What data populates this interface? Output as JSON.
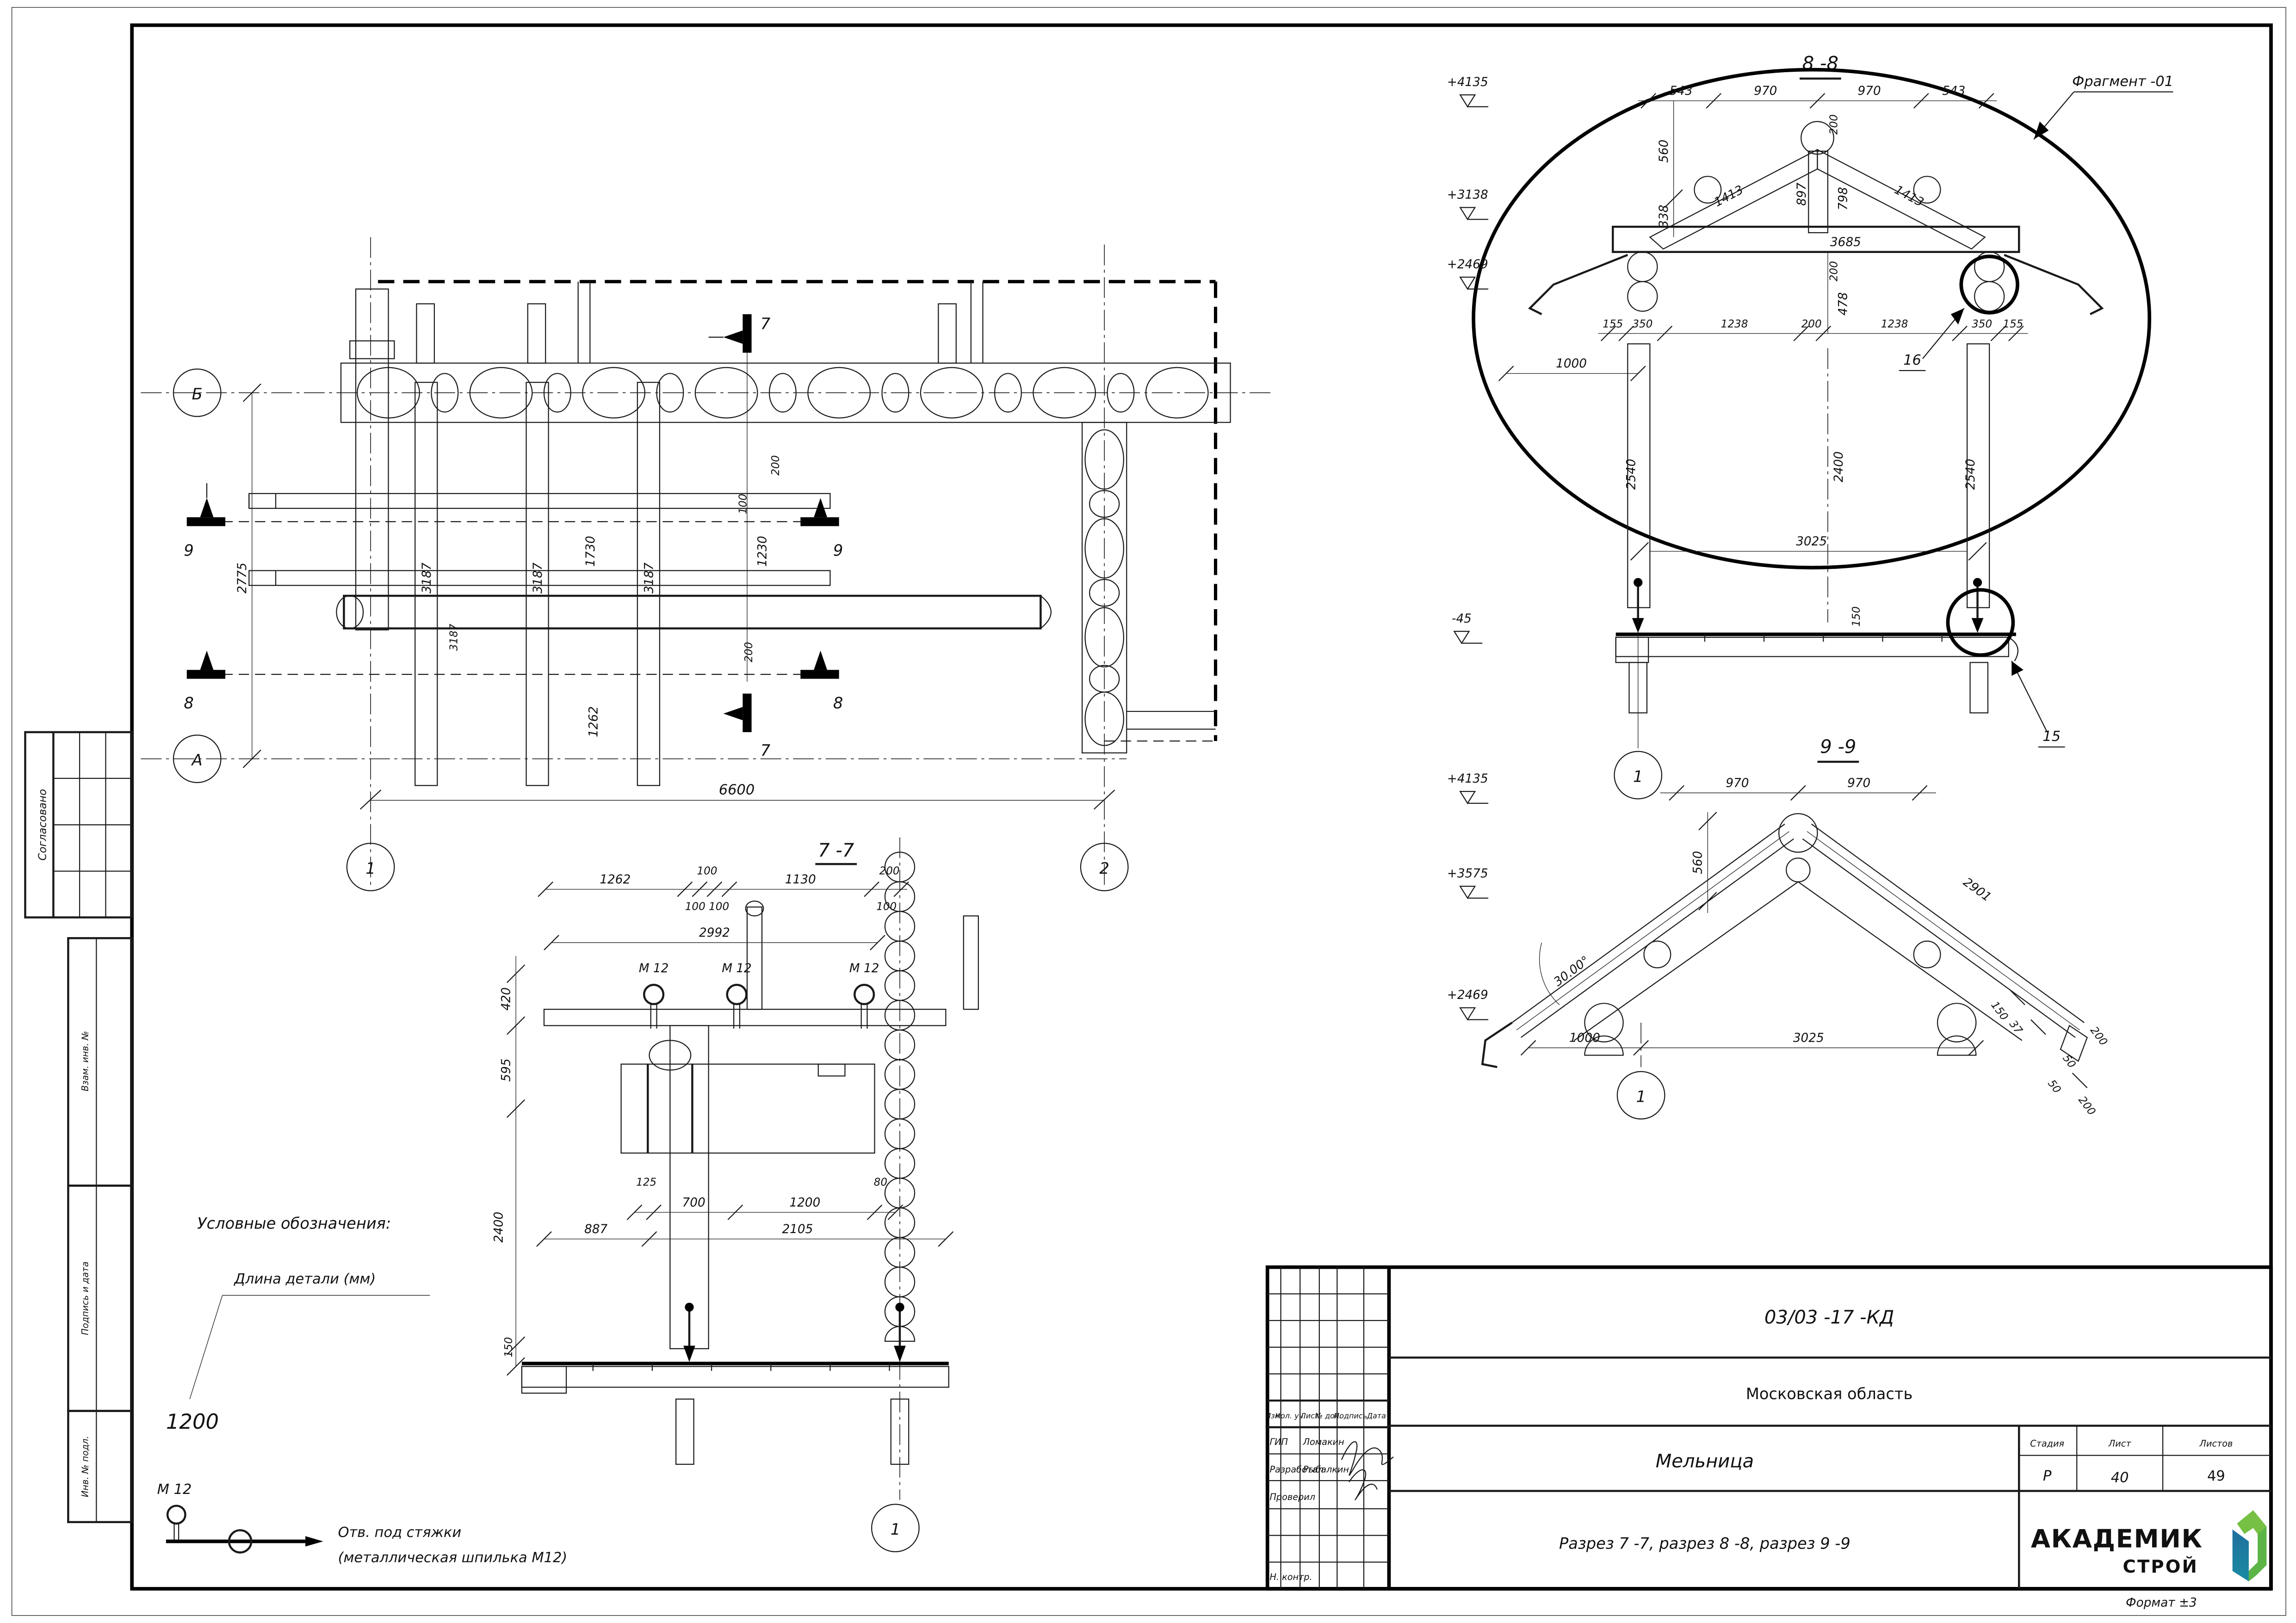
{
  "frame": {
    "format_note": "Формат ±3"
  },
  "stamp": {
    "doc_code": "03/03 -17 -КД",
    "region": "Московская область",
    "object_name": "Мельница",
    "sheet_title": "Разрез 7 -7, разрез 8 -8, разрез 9 -9",
    "cols": {
      "izm": "Изм.",
      "kol": "Кол. уч.",
      "list": "Лист",
      "doc": "№ док.",
      "sign": "Подпись",
      "date": "Дата"
    },
    "rows": {
      "gip_label": "ГИП",
      "gip_name": "Ломакин",
      "dev_label": "Разработал",
      "dev_name": "Рыбалкин",
      "check_label": "Проверил",
      "ncontr_label": "Н. контр."
    },
    "stage_label": "Стадия",
    "stage": "Р",
    "sheet_label": "Лист",
    "sheet": "40",
    "sheets_label": "Листов",
    "sheets": "49",
    "logo_line1": "АКАДЕМИК",
    "logo_line2": "СТРОЙ",
    "colors": {
      "logo_green": "#76c043",
      "logo_teal": "#21a393",
      "logo_blue": "#1f6f9f"
    }
  },
  "sidebar": {
    "agreed": "Согласовано",
    "vzam": "Взам. инв. №",
    "podp": "Подпись и дата",
    "inv": "Инв. № подл."
  },
  "legend": {
    "title": "Условные обозначения:",
    "len_label": "Длина детали (мм)",
    "len_value": "1200",
    "bolt_label": "М 12",
    "hole_caption_1": "Отв. под стяжки",
    "hole_caption_2": "(металлическая шпилька М12)"
  },
  "plan": {
    "axis_b": "Б",
    "axis_a": "А",
    "col1": "1",
    "col2": "2",
    "cut7": "7",
    "cut8": "8",
    "cut9": "9",
    "dims": {
      "d2775": "2775",
      "d3187": "3187",
      "d1730": "1730",
      "d1230": "1230",
      "d100": "100",
      "d200": "200",
      "d1262": "1262",
      "d6600": "6600"
    }
  },
  "s77": {
    "title": "7 -7",
    "top1": [
      "1262",
      "100",
      "1130",
      "200"
    ],
    "top2a": "100 100",
    "top2b": "100",
    "d2992": "2992",
    "m12": "М 12",
    "left": [
      "420",
      "595",
      "2400",
      "150"
    ],
    "mid": [
      "125",
      "700",
      "1200",
      "80"
    ],
    "low": [
      "887",
      "2105"
    ],
    "bubble": "1"
  },
  "s88": {
    "title": "8 -8",
    "fragment": "Фрагмент -01",
    "lev": [
      "+4135",
      "+3138",
      "+2469",
      "-45"
    ],
    "top": [
      "543",
      "970",
      "970",
      "543"
    ],
    "d200": "200",
    "left": [
      "560",
      "338"
    ],
    "d478": "478",
    "truss": {
      "r1": "1413",
      "r2": "1413",
      "ridge": "897",
      "d798": "798",
      "beam": "3685"
    },
    "row": [
      "155",
      "350",
      "1238",
      "200",
      "1238",
      "350",
      "155"
    ],
    "d1000": "1000",
    "post": "2540",
    "d2400": "2400",
    "d3025": "3025",
    "d150": "150",
    "callout16": "16",
    "callout15": "15",
    "bubble": "1"
  },
  "s99": {
    "title": "9 -9",
    "lev": [
      "+4135",
      "+3575",
      "+2469"
    ],
    "top": [
      "970",
      "970"
    ],
    "d2901": "2901",
    "d560": "560",
    "angle": "30.00°",
    "small": [
      "150",
      "37",
      "50",
      "50",
      "200",
      "200"
    ],
    "bottom": [
      "1000",
      "3025"
    ],
    "bubble": "1"
  }
}
